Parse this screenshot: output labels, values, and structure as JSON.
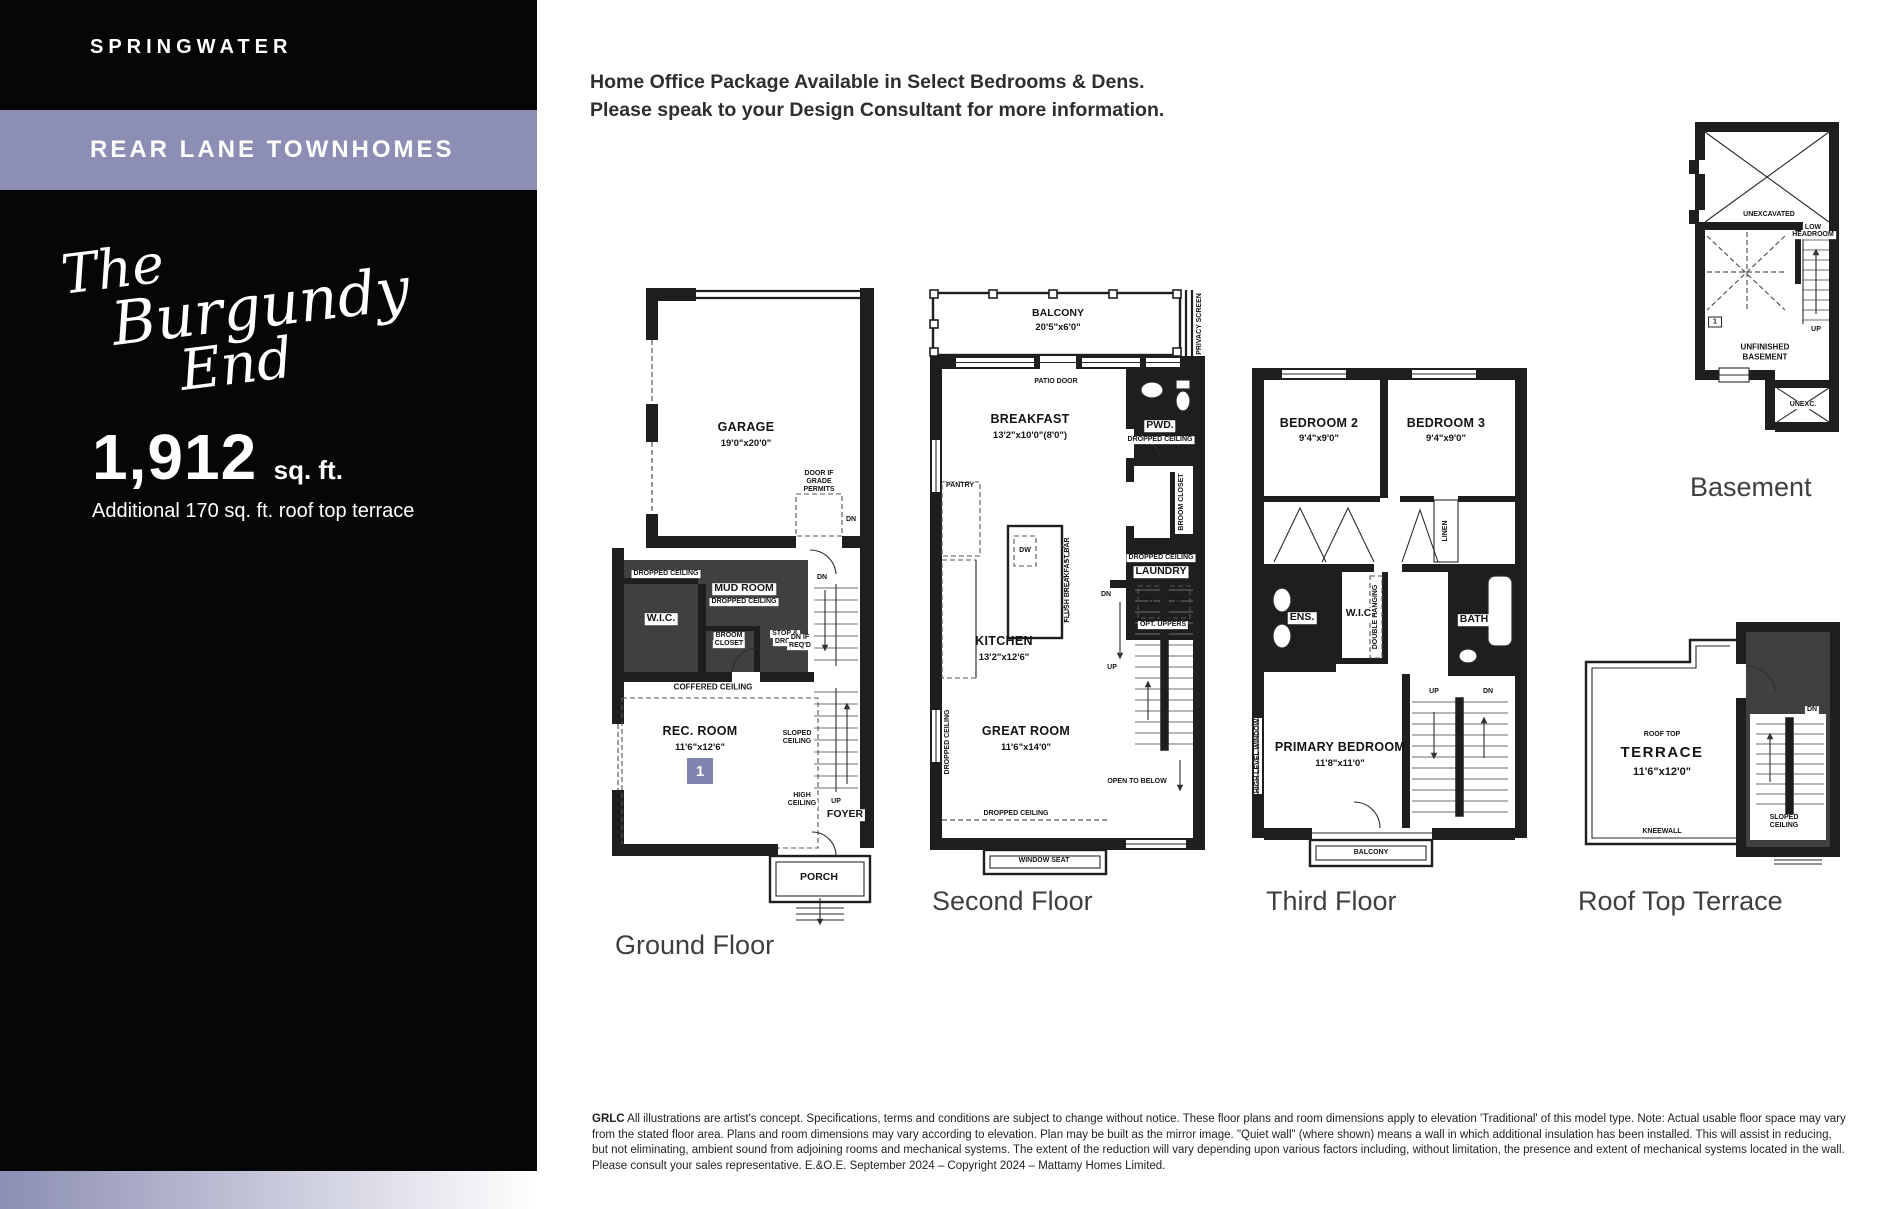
{
  "colors": {
    "accent_purple": "#8C8EB3",
    "badge_purple": "#8183AF",
    "wall_black": "#1E1E20"
  },
  "sidebar": {
    "community": "SPRINGWATER",
    "collection": "REAR LANE TOWNHOMES",
    "model_name_line1": "The",
    "model_name_line2": "Burgundy",
    "model_name_line3": "End",
    "area_value": "1,912",
    "area_unit": "sq. ft.",
    "area_note": "Additional 170 sq. ft. roof top terrace"
  },
  "header": {
    "line1": "Home Office Package Available in Select Bedrooms & Dens.",
    "line2": "Please speak to your Design Consultant for more information."
  },
  "plans": {
    "ground": {
      "caption": "Ground Floor",
      "garage": "GARAGE",
      "garage_dim": "19'0\"x20'0\"",
      "door_grade_1": "DOOR IF",
      "door_grade_2": "GRADE",
      "door_grade_3": "PERMITS",
      "dropped_ceiling_a": "DROPPED CEILING",
      "mud_room": "MUD ROOM",
      "dropped_ceiling_b": "DROPPED CEILING",
      "wic": "W.I.C.",
      "broom_1": "BROOM",
      "broom_2": "CLOSET",
      "stop_drop_1": "STOP &",
      "stop_drop_2": "DROP",
      "dn_a": "DN",
      "dn_b": "DN",
      "dn_if_req_1": "DN IF",
      "dn_if_req_2": "REQ'D",
      "coffered": "COFFERED CEILING",
      "rec_room": "REC. ROOM",
      "rec_room_dim": "11'6\"x12'6\"",
      "unit_badge": "1",
      "sloped_1": "SLOPED",
      "sloped_2": "CEILING",
      "up": "UP",
      "high_1": "HIGH",
      "high_2": "CEILING",
      "foyer": "FOYER",
      "porch": "PORCH"
    },
    "second": {
      "caption": "Second Floor",
      "balcony": "BALCONY",
      "balcony_dim": "20'5\"x6'0\"",
      "privacy_screen": "PRIVACY SCREEN",
      "patio_door": "PATIO DOOR",
      "breakfast": "BREAKFAST",
      "breakfast_dim": "13'2\"x10'0\"(8'0\")",
      "pwd": "PWD.",
      "dropped_ceiling_a": "DROPPED CEILING",
      "broom_closet": "BROOM CLOSET",
      "dropped_ceiling_b": "DROPPED CEILING",
      "laundry": "LAUNDRY",
      "d": "D",
      "w": "W",
      "opt_uppers": "OPT. UPPERS",
      "pantry": "PANTRY",
      "dw": "DW",
      "flush_bar": "FLUSH BREAKFAST BAR",
      "kitchen": "KITCHEN",
      "kitchen_dim": "13'2\"x12'6\"",
      "dropped_ceiling_c": "DROPPED CEILING",
      "great_room": "GREAT ROOM",
      "great_room_dim": "11'6\"x14'0\"",
      "dn": "DN",
      "up": "UP",
      "open_below": "OPEN TO BELOW",
      "dropped_ceiling_d": "DROPPED CEILING",
      "window_seat": "WINDOW SEAT"
    },
    "third": {
      "caption": "Third Floor",
      "bedroom2": "BEDROOM 2",
      "bedroom2_dim": "9'4\"x9'0\"",
      "bedroom3": "BEDROOM 3",
      "bedroom3_dim": "9'4\"x9'0\"",
      "linen": "LINEN",
      "ens": "ENS.",
      "wic": "W.I.C.",
      "double_hanging": "DOUBLE HANGING",
      "bath": "BATH",
      "high_level_window": "HIGH LEVEL WINDOW",
      "up": "UP",
      "dn": "DN",
      "primary": "PRIMARY BEDROOM",
      "primary_dim": "11'8\"x11'0\"",
      "balcony": "BALCONY"
    },
    "basement": {
      "caption": "Basement",
      "unexcavated": "UNEXCAVATED",
      "low_head_1": "LOW",
      "low_head_2": "HEADROOM",
      "up": "UP",
      "unit_badge": "1",
      "unfinished_1": "UNFINISHED",
      "unfinished_2": "BASEMENT",
      "unexc": "UNEXC."
    },
    "roof": {
      "caption": "Roof Top Terrace",
      "roof_top": "ROOF TOP",
      "terrace": "TERRACE",
      "terrace_dim": "11'6\"x12'0\"",
      "kneewall": "KNEEWALL",
      "dn": "DN",
      "sloped_1": "SLOPED",
      "sloped_2": "CEILING"
    }
  },
  "disclaimer": {
    "prefix": "GRLC",
    "text": " All illustrations are artist's concept. Specifications, terms and conditions are subject to change without notice. These floor plans and room dimensions apply to elevation 'Traditional' of this model type. Note: Actual usable floor space may vary from the stated floor area. Plans and room dimensions may vary according to elevation. Plan may be built as the mirror image. \"Quiet wall\" (where shown) means a wall in which additional insulation has been installed. This will assist in reducing, but not eliminating, ambient sound from adjoining rooms and mechanical systems. The extent of the reduction will vary depending upon various factors including, without limitation, the presence and extent of mechanical systems located in the wall. Please consult your sales representative. E.&O.E. September 2024 – Copyright 2024 – Mattamy Homes Limited."
  }
}
